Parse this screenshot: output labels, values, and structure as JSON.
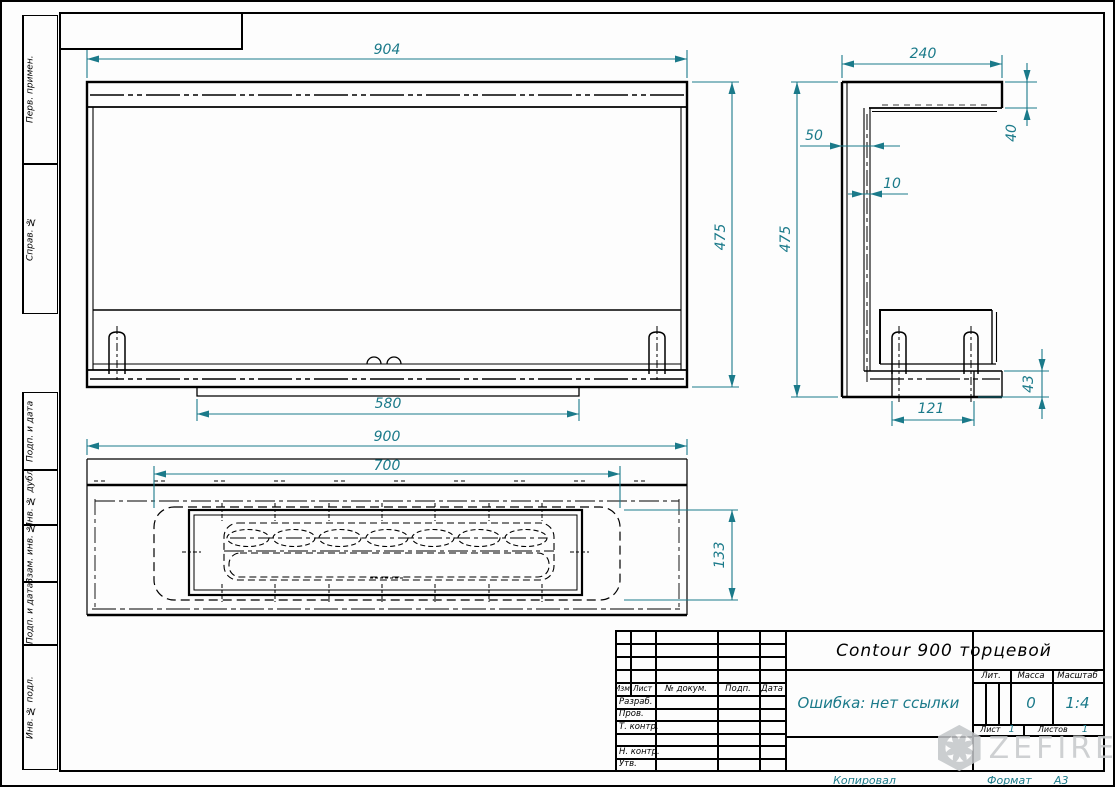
{
  "sheet": {
    "left_strip": [
      "Перв. примен.",
      "Справ. №",
      "Подп. и дата",
      "Инв. № дубл.",
      "Взам. инв. №",
      "Подп. и дата",
      "Инв. № подл."
    ]
  },
  "title_block": {
    "title": "Contour 900 торцевой",
    "doc_ref_error": "Ошибка: нет ссылки",
    "header_cols": {
      "izm": "Изм.",
      "list": "Лист",
      "doc": "№ докум.",
      "podp": "Подп.",
      "data": "Дата"
    },
    "rows": {
      "razrab": "Разраб.",
      "prov": "Пров.",
      "tkontr": "Т. контр.",
      "nkontr": "Н. контр.",
      "utv": "Утв."
    },
    "lit_label": "Лит.",
    "mass_label": "Масса",
    "scale_label": "Масштаб",
    "mass_value": "0",
    "scale_value": "1:4",
    "sheet_label": "Лист",
    "sheet_value": "1",
    "sheets_label": "Листов",
    "sheets_value": "1",
    "copied_label": "Копировал",
    "format_label": "Формат",
    "format_value": "А3"
  },
  "watermark": {
    "text": "ZEFIRE"
  },
  "dims": {
    "front_width": "904",
    "front_height": "475",
    "front_bottom": "580",
    "side_top": "240",
    "side_lip": "40",
    "side_offset": "50",
    "side_thickness": "10",
    "side_height": "475",
    "side_foot_height": "43",
    "side_foot_width": "121",
    "plan_width": "900",
    "plan_opening": "700",
    "plan_depth": "133"
  },
  "colors": {
    "dimension": "#1b7a8a",
    "line": "#000000",
    "watermark": "#c6c9cb"
  }
}
